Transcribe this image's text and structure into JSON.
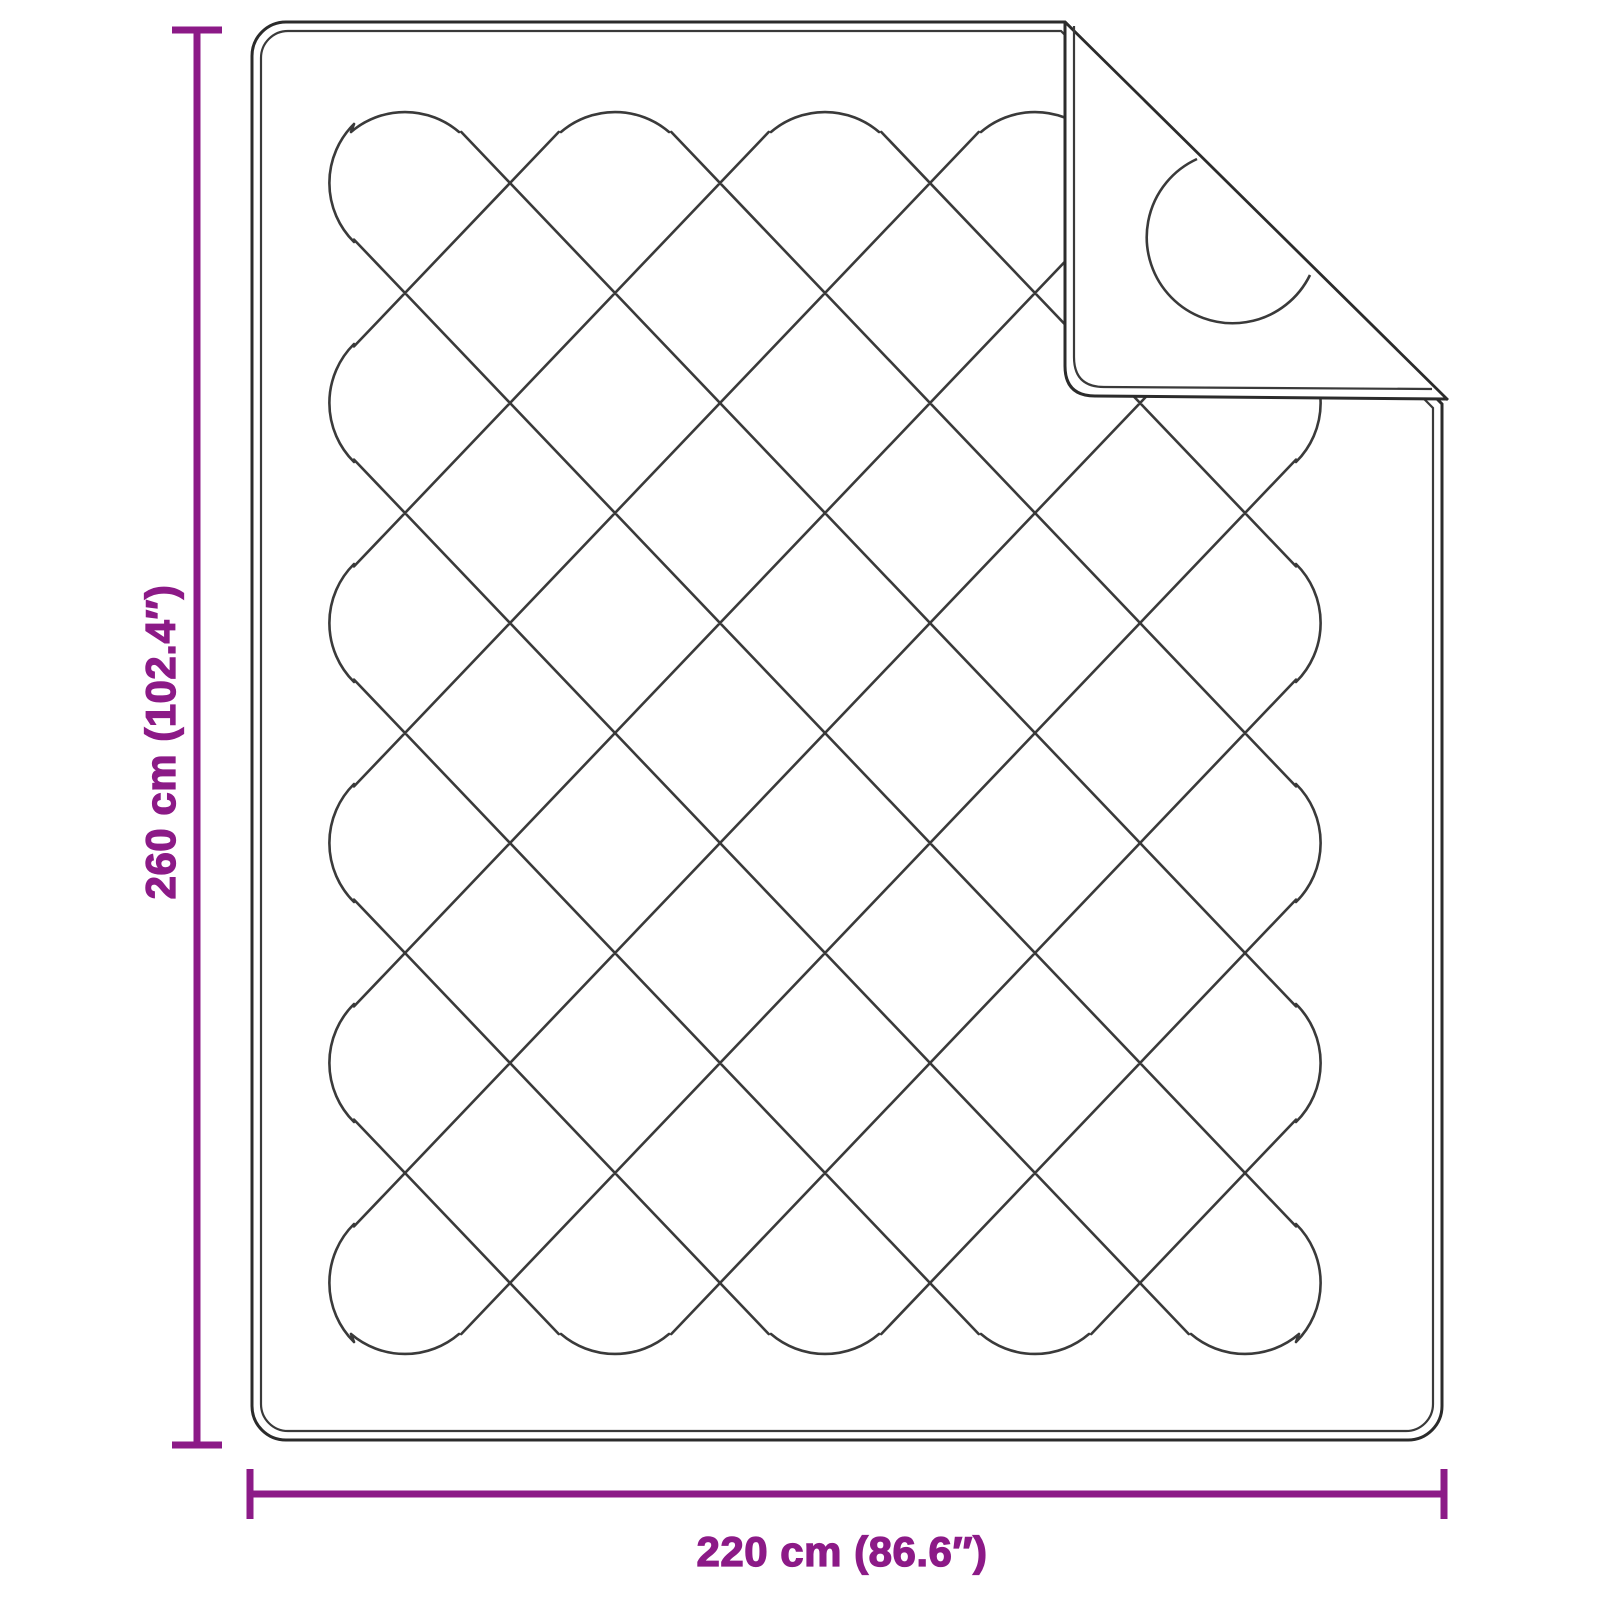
{
  "figure": {
    "type": "product-dimension-diagram",
    "product": "quilted blanket with folded corner",
    "vertical_dimension": {
      "label": "260 cm (102.4″)"
    },
    "horizontal_dimension": {
      "label": "220 cm (86.6″)"
    },
    "colors": {
      "accent": "#8C1A87",
      "outline": "#2b2b2b",
      "stitch": "#3a3a3a",
      "background": "#ffffff"
    }
  }
}
